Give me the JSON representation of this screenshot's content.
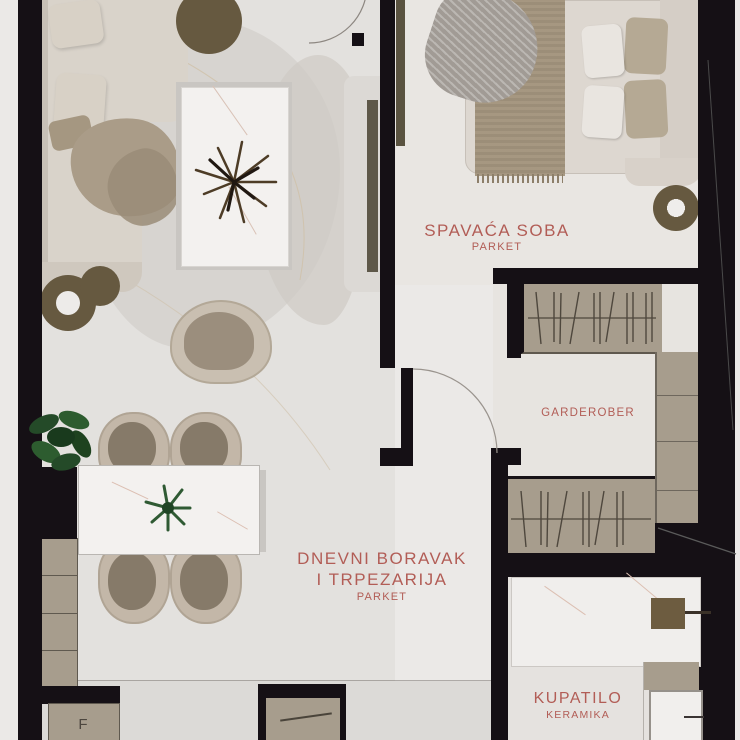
{
  "plan": {
    "title": "apartment-floor-plan",
    "rooms": {
      "bedroom": {
        "name": "SPAVAĆA SOBA",
        "floor": "PARKET"
      },
      "living": {
        "name_line1": "DNEVNI BORAVAK",
        "name_line2": "I TRPEZARIJA",
        "floor": "PARKET"
      },
      "wardrobe": {
        "name": "GARDEROBER"
      },
      "bathroom": {
        "name": "KUPATILO",
        "floor": "KERAMIKA"
      }
    },
    "labels": {
      "fridge": "F"
    },
    "colors": {
      "wall": "#151015",
      "room_label": "#b25d56",
      "cabinet": "#a79d8d",
      "accent_brown": "#665940",
      "sofa_cream": "#d9d3ca",
      "marble": "#f3f1ef",
      "floor_living": "#e3e1de",
      "floor_bedroom": "#e9e6e2",
      "floor_kitchen": "#dcdad7",
      "plant_green": "#2c5430"
    }
  }
}
